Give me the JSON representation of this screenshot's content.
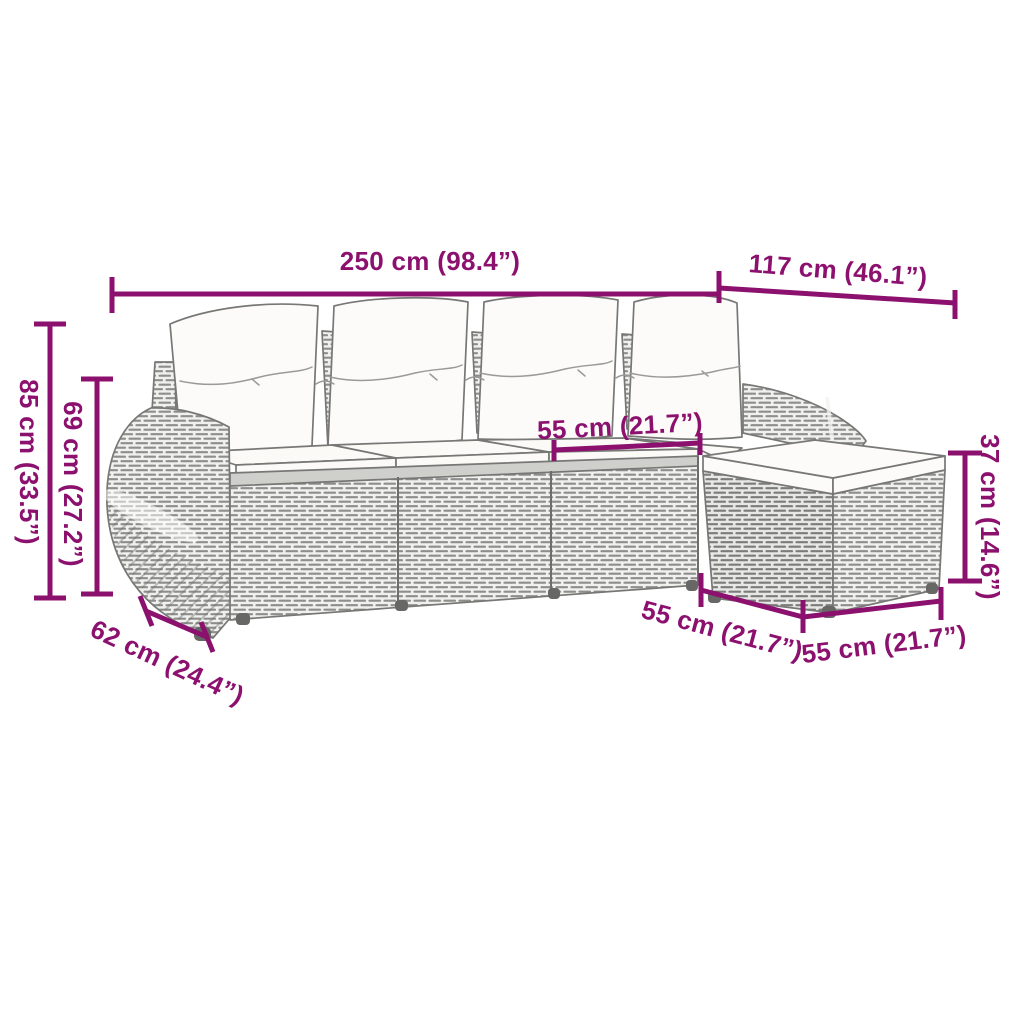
{
  "colors": {
    "dimension": "#8C116F",
    "outline": "#777775",
    "rattan_stroke": "#8E8E8C",
    "cushion_fill": "#FCFBF9"
  },
  "dimensions": {
    "total_width": {
      "label": "250 cm (98.4”)"
    },
    "chaise_length": {
      "label": "117 cm (46.1”)"
    },
    "total_height": {
      "label": "85 cm (33.5”)"
    },
    "arm_height": {
      "label": "69 cm (27.2”)"
    },
    "seat_width": {
      "label": "55 cm (21.7”)"
    },
    "stool_height": {
      "label": "37 cm (14.6”)"
    },
    "stool_depth": {
      "label": "55 cm (21.7”)"
    },
    "stool_width": {
      "label": "55 cm (21.7”)"
    },
    "arm_width": {
      "label": "62 cm (24.4”)"
    }
  }
}
